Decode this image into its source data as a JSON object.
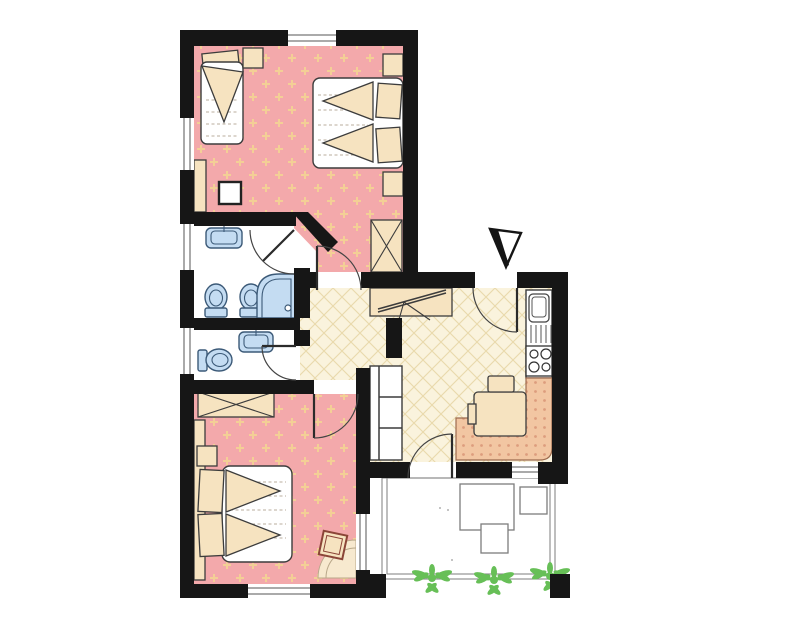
{
  "colors": {
    "wall": "#161616",
    "line": "#3c3c3c",
    "bedroom_floor": "#f3a9ab",
    "bedroom_floor_dot": "#f3cf96",
    "hall_floor": "#faf3dd",
    "hall_lattice": "#e9d9ab",
    "furniture_tan": "#f6e3c0",
    "fixture_blue": "#c4dcf2",
    "fixture_blue_stroke": "#3c5a78",
    "bench": "#f2c6a2",
    "bench_dot": "#dd9d7d",
    "plant_green": "#67bf57",
    "stool_stroke": "#8b4538",
    "balcony_line": "#888888",
    "paper": "#ffffff"
  },
  "plan": {
    "type": "apartment-floor-plan",
    "rooms": [
      {
        "name": "bedroom-top",
        "floor": "pink-dotted",
        "furniture": [
          "single-bed",
          "double-bed",
          "nightstand",
          "nightstand",
          "nightstand",
          "wardrobe",
          "side-table"
        ]
      },
      {
        "name": "bathroom-upper",
        "floor": "white",
        "fixtures": [
          "washbasin",
          "toilet",
          "bidet",
          "corner-shower"
        ]
      },
      {
        "name": "bathroom-lower",
        "floor": "white",
        "fixtures": [
          "washbasin",
          "toilet"
        ]
      },
      {
        "name": "hallway",
        "floor": "cream-lattice",
        "furniture": [
          "sideboard-luggage-rack"
        ]
      },
      {
        "name": "kitchen-living",
        "floor": "cream-lattice",
        "fixtures": [
          "sink",
          "stove"
        ],
        "furniture": [
          "corner-bench",
          "dining-table",
          "chair",
          "sofa"
        ]
      },
      {
        "name": "bedroom-bottom",
        "floor": "pink-dotted",
        "furniture": [
          "double-bed",
          "wardrobe",
          "nightstand",
          "stool",
          "corner-rug"
        ]
      },
      {
        "name": "balcony",
        "floor": "white",
        "furniture": [
          "table",
          "chair",
          "chair"
        ],
        "plants": 3
      }
    ],
    "doors": [
      "entrance",
      "bedroom-top",
      "bathroom-upper",
      "bathroom-lower",
      "bedroom-bottom",
      "balcony"
    ],
    "windows": 7,
    "entrance_marker": "triangle-arrow"
  }
}
